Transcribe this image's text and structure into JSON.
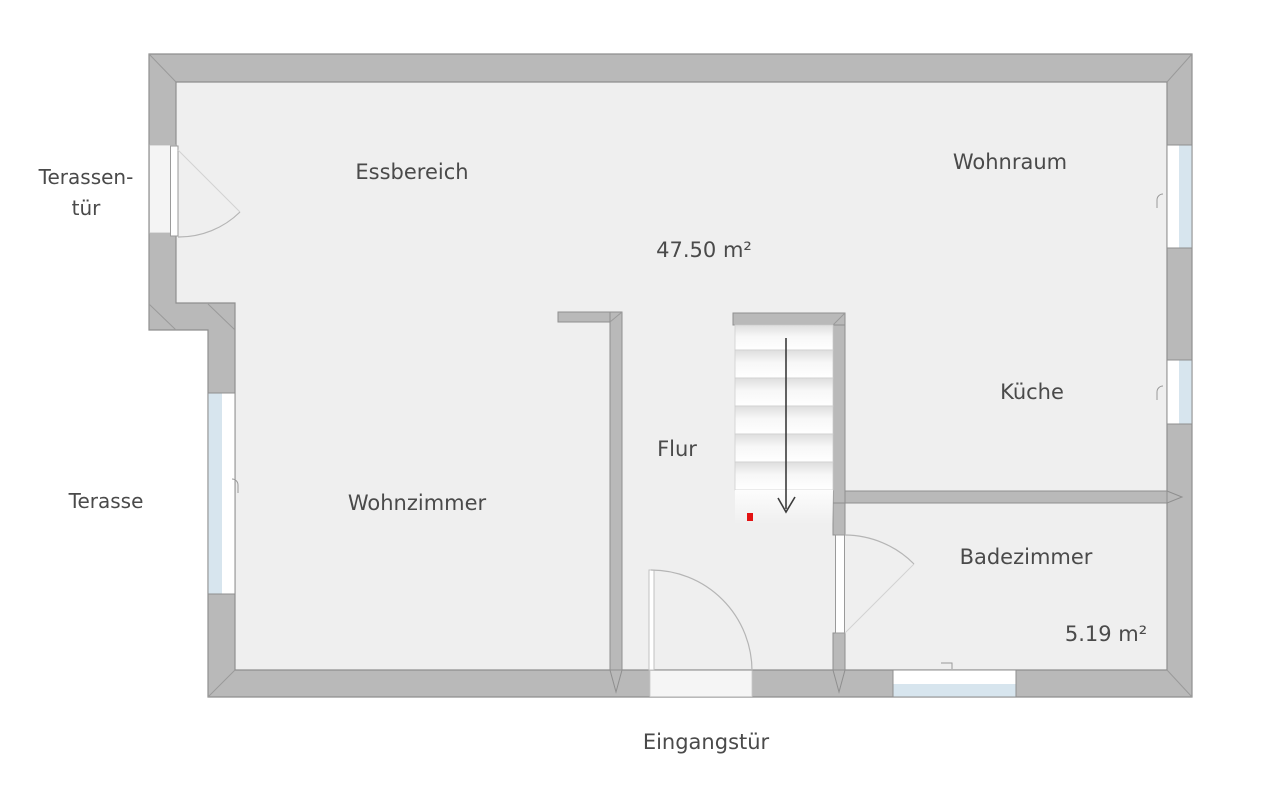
{
  "title": "Grundriss Erdgeschoss",
  "rooms": {
    "essbereich": "Essbereich",
    "wohnraum": "Wohnraum",
    "kueche": "Küche",
    "flur": "Flur",
    "wohnzimmer": "Wohnzimmer",
    "badezimmer": "Badezimmer"
  },
  "measurements": {
    "main_area": "47.50 m²",
    "bathroom_area": "5.19 m²"
  },
  "labels": {
    "terrace_door_line1": "Terassen-",
    "terrace_door_line2": "tür",
    "terrace": "Terasse",
    "entrance_door": "Eingangstür"
  },
  "colors": {
    "wall_fill": "#b9b9b9",
    "wall_edge": "#8f8f8f",
    "floor": "#efefef",
    "window_glass": "#d7e5ee",
    "door_leaf": "#ffffff",
    "swing_arc": "#b5b5b5",
    "stair_arrow": "#3c3c3c",
    "start_marker_red": "#e31212",
    "label_text": "#4a4a4a"
  }
}
